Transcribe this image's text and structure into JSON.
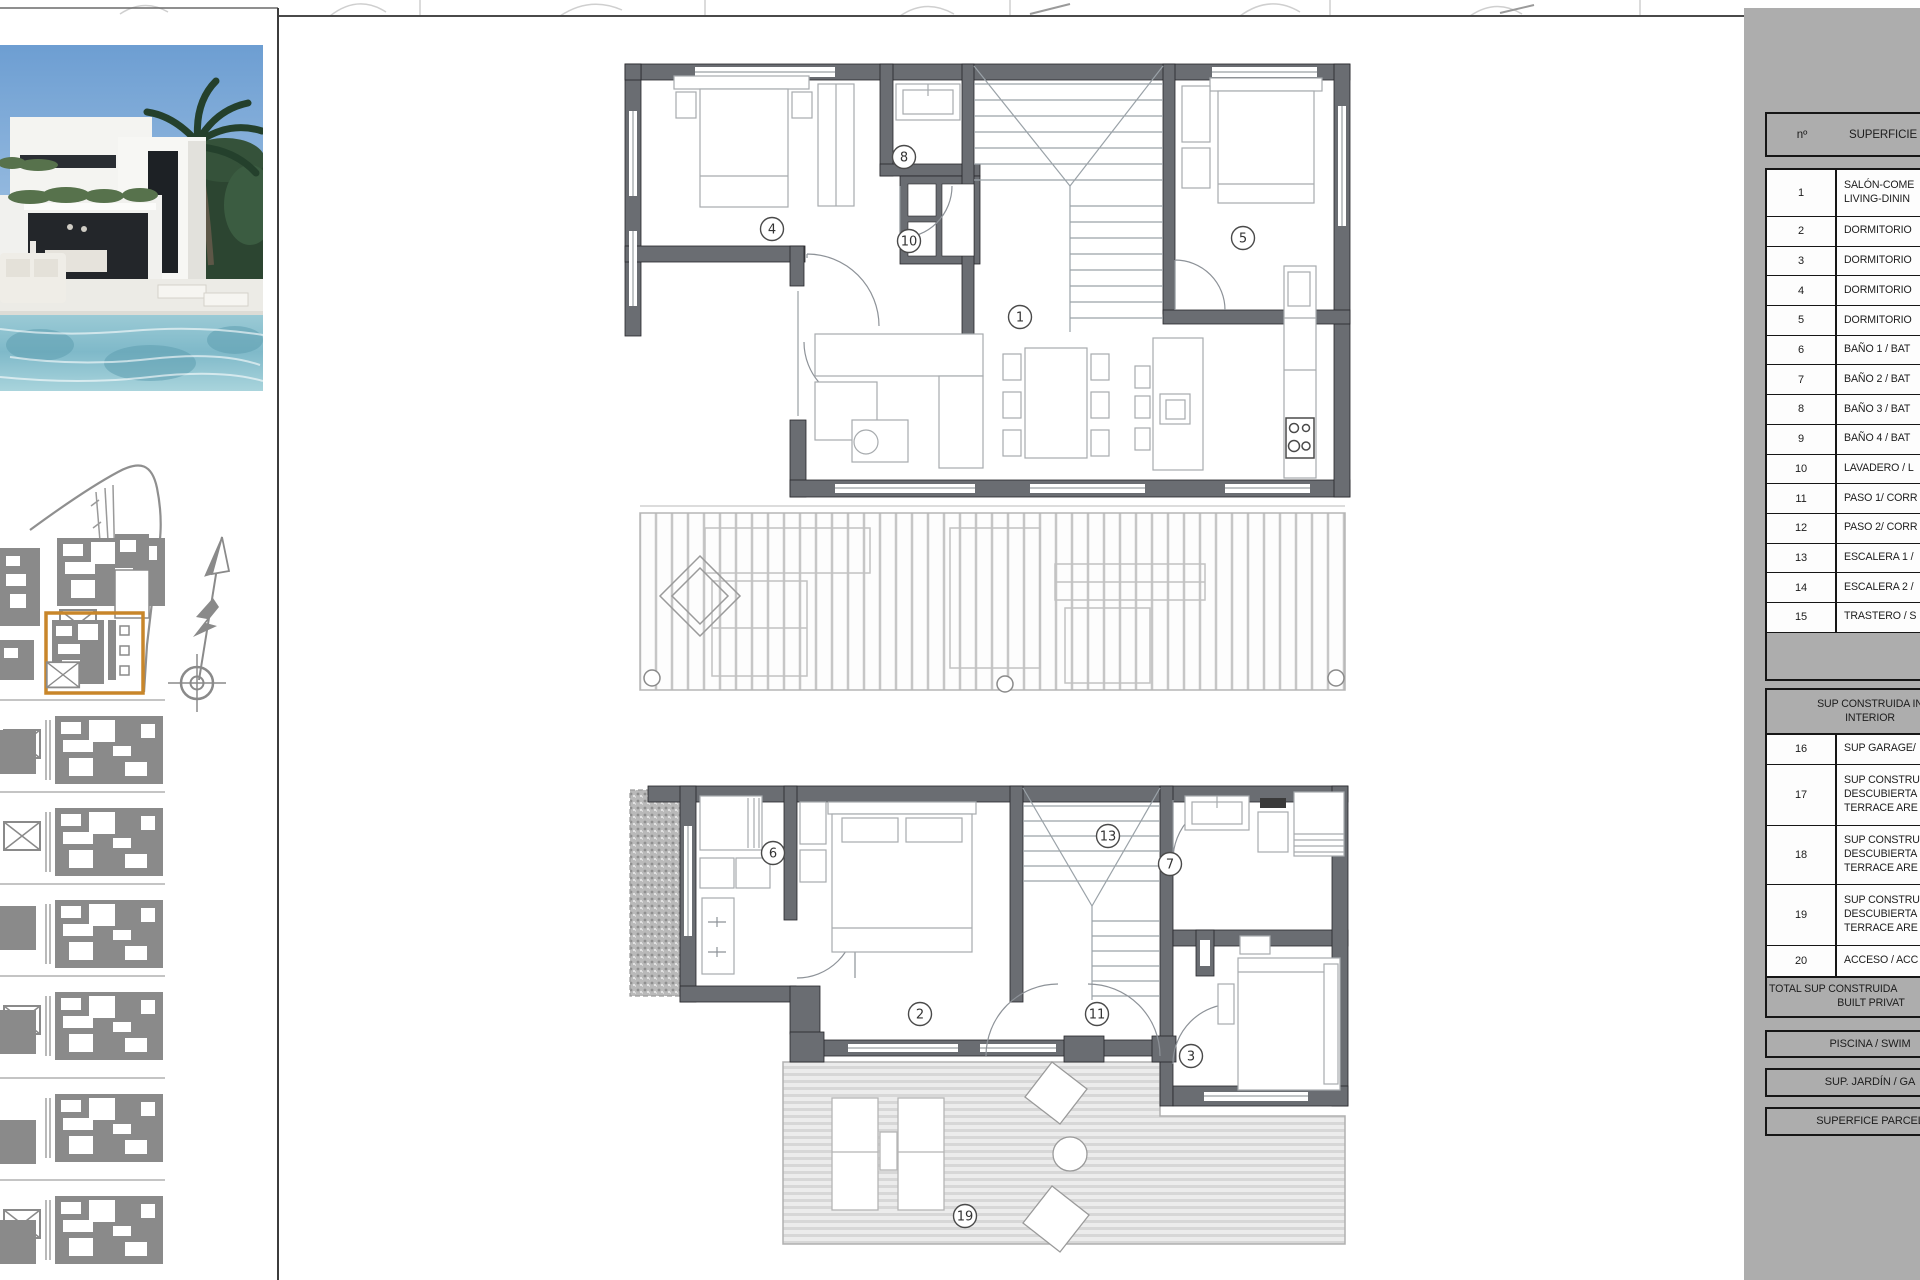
{
  "colors": {
    "panel_gray": "#adadad",
    "wall_gray": "#6a6d72",
    "drawing_line_gray": "#9aa0a4",
    "site_plan_gray": "#8a8a8a",
    "highlight_orange": "#c8862a",
    "pool_blue": "#8cc4cf",
    "sky_blue": "#7fa9d6"
  },
  "legend": {
    "header": {
      "num_label": "nº",
      "title": "SUPERFICIE Ú"
    },
    "rows": [
      {
        "num": "1",
        "lines": [
          "SALÓN-COME",
          "LIVING-DININ"
        ],
        "h": 47
      },
      {
        "num": "2",
        "lines": [
          "DORMITORIO"
        ],
        "h": 29.7
      },
      {
        "num": "3",
        "lines": [
          "DORMITORIO"
        ],
        "h": 29.7
      },
      {
        "num": "4",
        "lines": [
          "DORMITORIO"
        ],
        "h": 29.7
      },
      {
        "num": "5",
        "lines": [
          "DORMITORIO"
        ],
        "h": 29.7
      },
      {
        "num": "6",
        "lines": [
          "BAÑO 1 / BAT"
        ],
        "h": 29.7
      },
      {
        "num": "7",
        "lines": [
          "BAÑO 2 / BAT"
        ],
        "h": 29.7
      },
      {
        "num": "8",
        "lines": [
          "BAÑO 3 / BAT"
        ],
        "h": 29.7
      },
      {
        "num": "9",
        "lines": [
          "BAÑO 4 / BAT"
        ],
        "h": 29.7
      },
      {
        "num": "10",
        "lines": [
          "LAVADERO / L"
        ],
        "h": 29.7
      },
      {
        "num": "11",
        "lines": [
          "PASO 1/ CORR"
        ],
        "h": 29.7
      },
      {
        "num": "12",
        "lines": [
          "PASO 2/ CORR"
        ],
        "h": 29.7
      },
      {
        "num": "13",
        "lines": [
          "ESCALERA 1 /"
        ],
        "h": 29.7
      },
      {
        "num": "14",
        "lines": [
          "ESCALERA 2 /"
        ],
        "h": 29.7
      },
      {
        "num": "15",
        "lines": [
          "TRASTERO / S"
        ],
        "h": 29.7
      },
      {
        "num": "",
        "lines": [
          ""
        ],
        "h": 46,
        "empty": true
      }
    ],
    "section_header": [
      "SUP CONSTRUIDA IN",
      "INTERIOR"
    ],
    "rows2": [
      {
        "num": "16",
        "lines": [
          "SUP GARAGE/"
        ],
        "h": 30
      },
      {
        "num": "17",
        "lines": [
          "SUP CONSTRU",
          "DESCUBIERTA",
          "TERRACE ARE"
        ],
        "h": 61
      },
      {
        "num": "18",
        "lines": [
          "SUP CONSTRU",
          "DESCUBIERTA",
          "TERRACE ARE"
        ],
        "h": 59
      },
      {
        "num": "19",
        "lines": [
          "SUP CONSTRU",
          "DESCUBIERTA",
          "TERRACE ARE"
        ],
        "h": 61
      },
      {
        "num": "20",
        "lines": [
          "ACCESO / ACC"
        ],
        "h": 30
      }
    ],
    "total": [
      "TOTAL SUP CONSTRUIDA",
      "BUILT PRIVAT"
    ],
    "footers": [
      "PISCINA / SWIM",
      "SUP. JARDÍN / GA",
      "SUPERFICE PARCEL"
    ]
  },
  "floor_plans": {
    "upper": {
      "label": "upper floor plan",
      "markers": [
        {
          "n": "4",
          "x": 172,
          "y": 193
        },
        {
          "n": "8",
          "x": 304,
          "y": 121
        },
        {
          "n": "10",
          "x": 309,
          "y": 205
        },
        {
          "n": "5",
          "x": 643,
          "y": 202
        },
        {
          "n": "1",
          "x": 420,
          "y": 281
        }
      ]
    },
    "lower": {
      "label": "ground floor plan",
      "markers": [
        {
          "n": "6",
          "x": 173,
          "y": 97
        },
        {
          "n": "13",
          "x": 508,
          "y": 80
        },
        {
          "n": "7",
          "x": 570,
          "y": 108
        },
        {
          "n": "2",
          "x": 320,
          "y": 258
        },
        {
          "n": "11",
          "x": 497,
          "y": 258
        },
        {
          "n": "3",
          "x": 591,
          "y": 300
        },
        {
          "n": "19",
          "x": 365,
          "y": 460
        }
      ]
    }
  }
}
